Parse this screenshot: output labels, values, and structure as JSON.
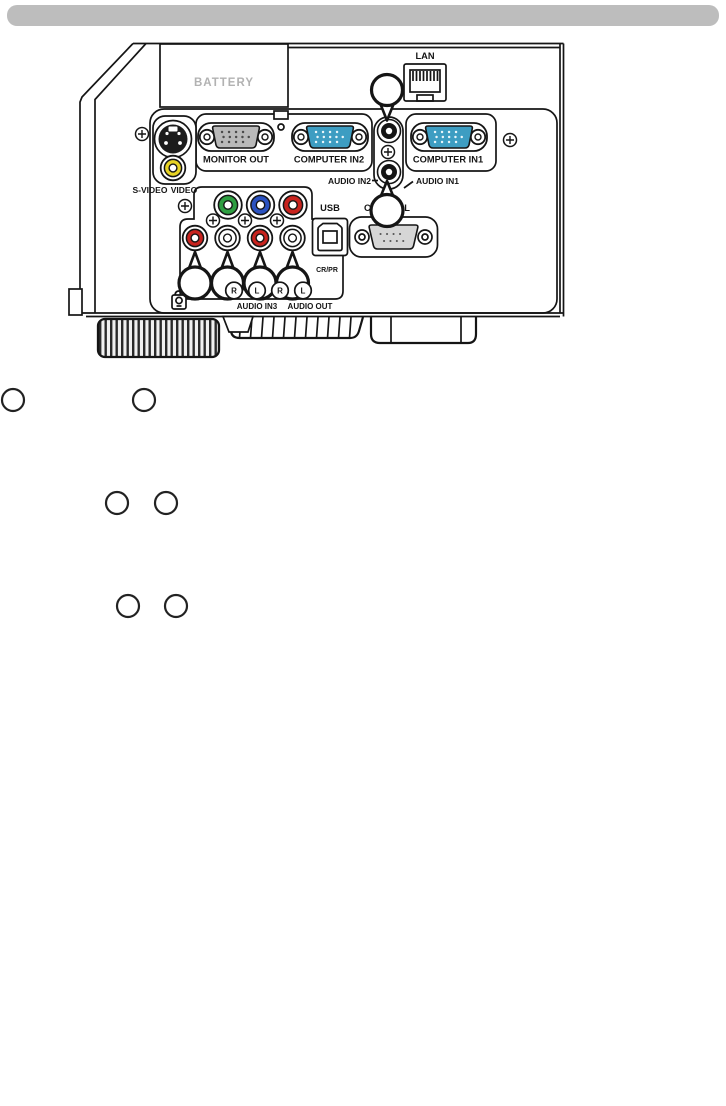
{
  "header_bar": {
    "color": "#bdbdbd"
  },
  "rear_panel_diagram": {
    "labels": {
      "battery": "BATTERY",
      "lan": "LAN",
      "monitor_out": "MONITOR OUT",
      "computer_in2": "COMPUTER IN2",
      "computer_in1": "COMPUTER IN1",
      "audio_in2": "AUDIO IN2",
      "audio_in1": "AUDIO IN1",
      "s_video": "S-VIDEO",
      "video": "VIDEO",
      "usb": "USB",
      "control": "CONTROL",
      "component_cr_pr": "CR/PR",
      "audio_in3": "AUDIO IN3",
      "audio_out": "AUDIO OUT"
    },
    "audio_channel_labels": [
      "R",
      "L",
      "R",
      "L"
    ],
    "colors": {
      "vga_blue": "#3d9dc2",
      "vga_gray": "#b9b9b9",
      "component_green": "#2e9e41",
      "component_blue": "#2b52c0",
      "jack_red": "#c8231e",
      "jack_white": "#ffffff",
      "video_yellow": "#e7d324",
      "dsub_gray": "#d6d6d6",
      "line": "#151515"
    }
  }
}
